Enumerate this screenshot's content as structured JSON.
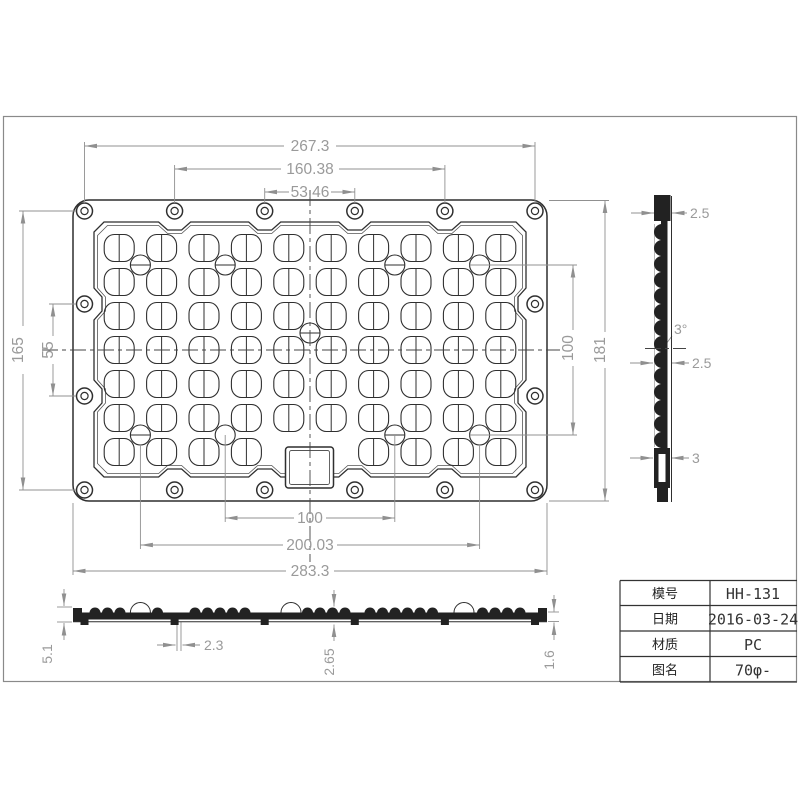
{
  "drawing": {
    "type": "LED lens array engineering drawing",
    "lens_grid": {
      "columns": 10,
      "rows": 7,
      "interstitial_circles": 9,
      "mounting_holes": 16
    }
  },
  "dims": {
    "w_outer": "267.3",
    "w_mid": "160.38",
    "w_inner": "53.46",
    "h_outer": "165",
    "h_mid": "55",
    "h_led": "100",
    "h_total": "181",
    "w_led": "100",
    "w_led_outer": "200.03",
    "w_total": "283.3",
    "side_top": "2.5",
    "side_angle": "3°",
    "side_mid": "2.5",
    "side_bottom": "3",
    "p_height": "5.1",
    "p_rib": "2.3",
    "p_wall": "2.65",
    "p_edge": "1.6"
  },
  "title_block": {
    "rows": [
      {
        "label": "模号",
        "value": "HH-131"
      },
      {
        "label": "日期",
        "value": "2016-03-24"
      },
      {
        "label": "材质",
        "value": "PC"
      },
      {
        "label": "图名",
        "value": "70φ-"
      }
    ]
  }
}
